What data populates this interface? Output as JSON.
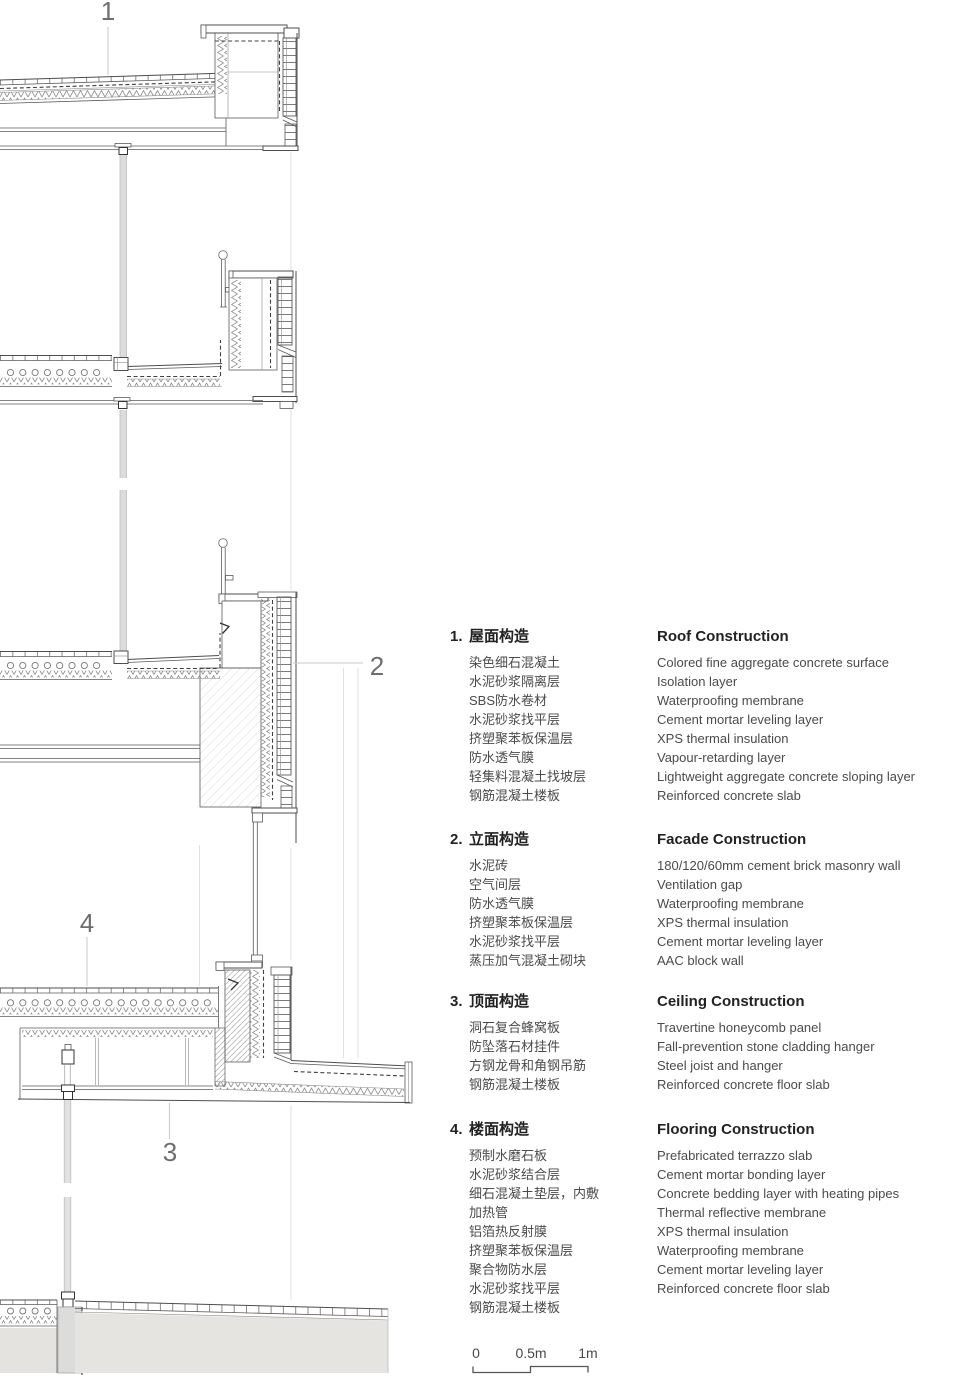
{
  "drawing": {
    "callouts": [
      {
        "label": "1"
      },
      {
        "label": "2"
      },
      {
        "label": "3"
      },
      {
        "label": "4"
      }
    ]
  },
  "legend": {
    "sections": [
      {
        "number": "1.",
        "title_zh": "屋面构造",
        "title_en": "Roof Construction",
        "items": [
          {
            "zh": "染色细石混凝土",
            "en": "Colored fine aggregate concrete surface"
          },
          {
            "zh": "水泥砂浆隔离层",
            "en": "Isolation layer"
          },
          {
            "zh": "SBS防水卷材",
            "en": "Waterproofing membrane"
          },
          {
            "zh": "水泥砂浆找平层",
            "en": "Cement mortar leveling layer"
          },
          {
            "zh": "挤塑聚苯板保温层",
            "en": "XPS thermal insulation"
          },
          {
            "zh": "防水透气膜",
            "en": "Vapour-retarding layer"
          },
          {
            "zh": "轻集料混凝土找坡层",
            "en": "Lightweight aggregate concrete sloping layer"
          },
          {
            "zh": "钢筋混凝土楼板",
            "en": "Reinforced concrete slab"
          }
        ]
      },
      {
        "number": "2.",
        "title_zh": "立面构造",
        "title_en": "Facade Construction",
        "items": [
          {
            "zh": "水泥砖",
            "en": "180/120/60mm cement brick masonry wall"
          },
          {
            "zh": "空气间层",
            "en": "Ventilation gap"
          },
          {
            "zh": "防水透气膜",
            "en": "Waterproofing membrane"
          },
          {
            "zh": "挤塑聚苯板保温层",
            "en": "XPS thermal insulation"
          },
          {
            "zh": "水泥砂浆找平层",
            "en": "Cement mortar leveling layer"
          },
          {
            "zh": "蒸压加气混凝土砌块",
            "en": "AAC block wall"
          }
        ]
      },
      {
        "number": "3.",
        "title_zh": "顶面构造",
        "title_en": "Ceiling Construction",
        "items": [
          {
            "zh": "洞石复合蜂窝板",
            "en": "Travertine honeycomb panel"
          },
          {
            "zh": "防坠落石材挂件",
            "en": "Fall-prevention stone cladding hanger"
          },
          {
            "zh": "方钢龙骨和角钢吊筋",
            "en": "Steel joist and hanger"
          },
          {
            "zh": "钢筋混凝土楼板",
            "en": "Reinforced concrete floor slab"
          }
        ]
      },
      {
        "number": "4.",
        "title_zh": "楼面构造",
        "title_en": "Flooring Construction",
        "items": [
          {
            "zh": "预制水磨石板",
            "en": "Prefabricated terrazzo slab"
          },
          {
            "zh": "水泥砂浆结合层",
            "en": "Cement mortar bonding layer"
          },
          {
            "zh": "细石混凝土垫层，内敷",
            "en": "Concrete bedding layer with heating pipes"
          },
          {
            "zh": "加热管",
            "en": "Thermal reflective membrane"
          },
          {
            "zh": "铝箔热反射膜",
            "en": "XPS thermal insulation"
          },
          {
            "zh": "挤塑聚苯板保温层",
            "en": "Waterproofing membrane"
          },
          {
            "zh": "聚合物防水层",
            "en": "Cement mortar leveling layer"
          },
          {
            "zh": "水泥砂浆找平层",
            "en": "Reinforced concrete floor slab"
          },
          {
            "zh": "钢筋混凝土楼板",
            "en": ""
          }
        ]
      }
    ]
  },
  "scale_bar": {
    "labels": [
      "0",
      "0.5m",
      "1m"
    ]
  },
  "colors": {
    "line": "#4d4d4d",
    "legend_heading": "#222222",
    "legend_text": "#4b4b4b",
    "callout_text": "#6e6e6e",
    "gray_fill": "#dcdcdc",
    "ground_fill": "#e5e4e1"
  }
}
